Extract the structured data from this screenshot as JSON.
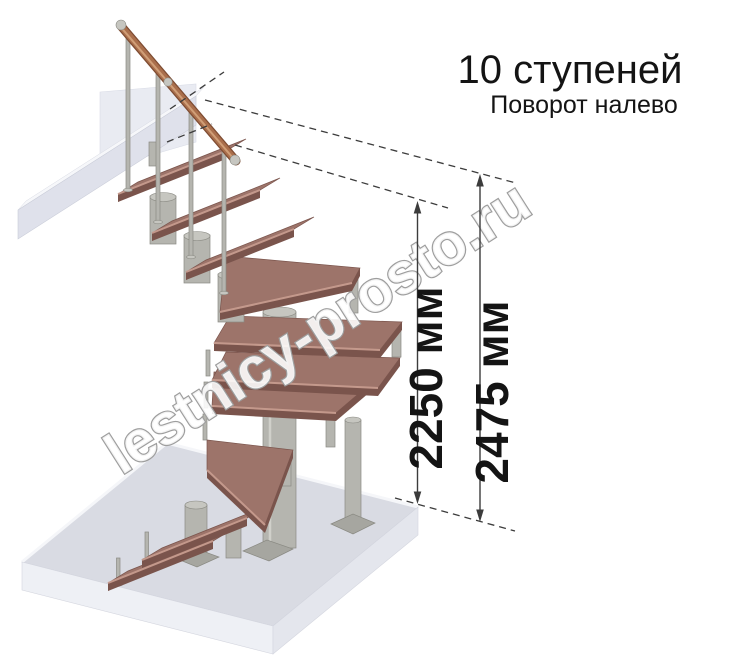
{
  "header": {
    "title": "10 ступеней",
    "subtitle": "Поворот налево"
  },
  "dimension_annotations": {
    "inner_height": "2250 мм",
    "total_height": "2475 мм"
  },
  "watermark": {
    "text": "lestnicy-prosto.ru"
  },
  "illustration": {
    "step_count_shown": 10
  },
  "colors": {
    "tread": "#9d746a",
    "tread-dark": "#7a544c",
    "tread-nose": "#cba092",
    "metal": "#b5b5af",
    "metal-dark": "#8a8a83",
    "metal-hi": "#d9d9d4",
    "plate": "#a6a6a0",
    "floor": "#d9dbe3",
    "floor-face": "#eef0f5",
    "floor-face-right": "#e4e6ed",
    "beam": "#dfe1eb",
    "beam-top": "#f6f7fa",
    "panel": "#e9ebf2",
    "rail": "#aa6f4c",
    "rail-dark": "#7e4c32",
    "rail-hi": "#d7a77f",
    "dim": "#3c3c3c",
    "text": "#141414",
    "wm": "#9e9e9e"
  }
}
